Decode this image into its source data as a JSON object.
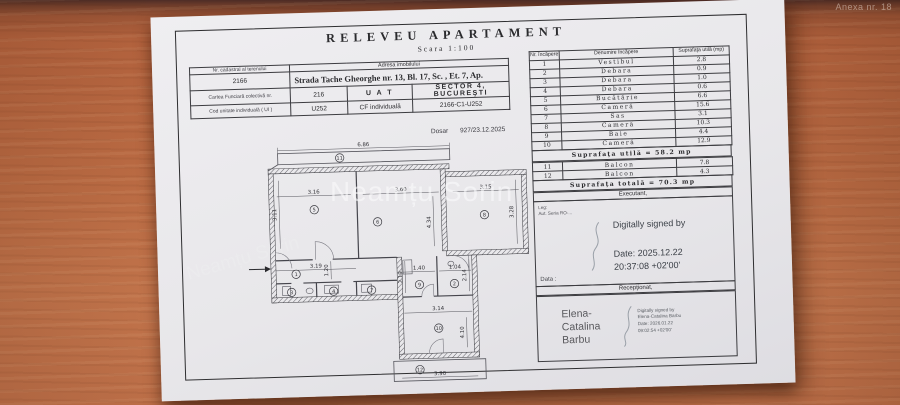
{
  "photo": {
    "annotation_top_right": "Anexa nr. 18",
    "watermark": "Neamțu Sorin"
  },
  "document": {
    "title": "RELEVEU APARTAMENT",
    "scale": "Scara 1:100",
    "dosar_label": "Dosar",
    "dosar_value": "927/23.12.2025"
  },
  "address_table": {
    "nr_cadastral_label": "Nr. cadastral al terenului",
    "nr_cadastral_value": "2166",
    "adresa_label": "Adresa imobilului",
    "adresa_value": "Strada Tache Gheorghe nr. 13, Bl. 17, Sc.  , Et. 7, Ap.",
    "carte_funciara_label": "Cartea Funciară colectivă nr.",
    "carte_funciara_value": "216",
    "uat_label": "U A T",
    "uat_value": "SECTOR 4, BUCUREŞTI",
    "cod_unitate_label": "Cod unitate individuală ( UI )",
    "cod_unitate_value": "U252",
    "cf_individuala_label": "CF individuală",
    "cf_individuala_value": "2166-C1-U252"
  },
  "rooms_table": {
    "header": {
      "col1": "Nr. încăpere",
      "col2": "Denumire încăpere",
      "col3": "Suprafaţa utilă (mp)"
    },
    "rows": [
      [
        "1",
        "Vestibul",
        "2.8"
      ],
      [
        "2",
        "Debara",
        "0.9"
      ],
      [
        "3",
        "Debara",
        "1.0"
      ],
      [
        "4",
        "Debara",
        "0.6"
      ],
      [
        "5",
        "Bucătărie",
        "6.6"
      ],
      [
        "6",
        "Cameră",
        "15.6"
      ],
      [
        "7",
        "Sas",
        "3.1"
      ],
      [
        "8",
        "Cameră",
        "10.3"
      ],
      [
        "9",
        "Baie",
        "4.4"
      ],
      [
        "10",
        "Cameră",
        "12.9"
      ]
    ],
    "subtotal": "Suprafaţa utilă = 58.2 mp",
    "balcony_rows": [
      [
        "11",
        "Balcon",
        "7.8"
      ],
      [
        "12",
        "Balcon",
        "4.3"
      ]
    ],
    "total": "Suprafaţa totală = 70.3 mp"
  },
  "executant": {
    "header": "Executant,",
    "leg_label": "Leg:",
    "aut_label": "Aut. Seria RO-...",
    "signed_by": "Digitally signed by",
    "date_line1": "Date: 2025.12.22",
    "date_line2": "20:37:08 +02'00'",
    "data_label": "Data :"
  },
  "receptionat": {
    "header": "Recepţionat,",
    "name_lines": [
      "Elena-",
      "Catalina",
      "Barbu"
    ],
    "sig_lines": [
      "Digitally signed by",
      "Elena-Catalina Barbu",
      "Date: 2026.01.22",
      "09:02:54 +02'00'"
    ]
  },
  "floor_plan": {
    "dimensions": [
      {
        "t": "6.86",
        "x": 146,
        "y": 8,
        "r": 0
      },
      {
        "t": "3.16",
        "x": 95,
        "y": 54,
        "r": 0
      },
      {
        "t": "3.60",
        "x": 182,
        "y": 54,
        "r": 0
      },
      {
        "t": "3.15",
        "x": 267,
        "y": 54,
        "r": 0
      },
      {
        "t": "3.11",
        "x": 57,
        "y": 74,
        "r": -90
      },
      {
        "t": "3.28",
        "x": 294,
        "y": 78,
        "r": -90
      },
      {
        "t": "4.34",
        "x": 211,
        "y": 86,
        "r": -90
      },
      {
        "t": "3.19",
        "x": 95,
        "y": 128,
        "r": 0
      },
      {
        "t": "1.20",
        "x": 107,
        "y": 131,
        "r": -90
      },
      {
        "t": "1.40",
        "x": 198,
        "y": 133,
        "r": 0
      },
      {
        "t": "1.04",
        "x": 234,
        "y": 133,
        "r": 0
      },
      {
        "t": "2.19",
        "x": 181,
        "y": 140,
        "r": -90
      },
      {
        "t": "2.14",
        "x": 245,
        "y": 140,
        "r": -90
      },
      {
        "t": "3.14",
        "x": 216,
        "y": 174,
        "r": 0
      },
      {
        "t": "4.10",
        "x": 241,
        "y": 197,
        "r": -90
      },
      {
        "t": "3.90",
        "x": 216,
        "y": 239,
        "r": 0
      }
    ],
    "room_numbers": [
      {
        "n": "11",
        "x": 122,
        "y": 19
      },
      {
        "n": "5",
        "x": 95,
        "y": 70
      },
      {
        "n": "6",
        "x": 158,
        "y": 84
      },
      {
        "n": "8",
        "x": 265,
        "y": 80
      },
      {
        "n": "1",
        "x": 75,
        "y": 134
      },
      {
        "n": "3",
        "x": 70,
        "y": 152
      },
      {
        "n": "4",
        "x": 112,
        "y": 152
      },
      {
        "n": "7",
        "x": 150,
        "y": 152
      },
      {
        "n": "9",
        "x": 198,
        "y": 148
      },
      {
        "n": "2",
        "x": 233,
        "y": 148
      },
      {
        "n": "10",
        "x": 216,
        "y": 192
      },
      {
        "n": "12",
        "x": 196,
        "y": 233
      }
    ]
  }
}
